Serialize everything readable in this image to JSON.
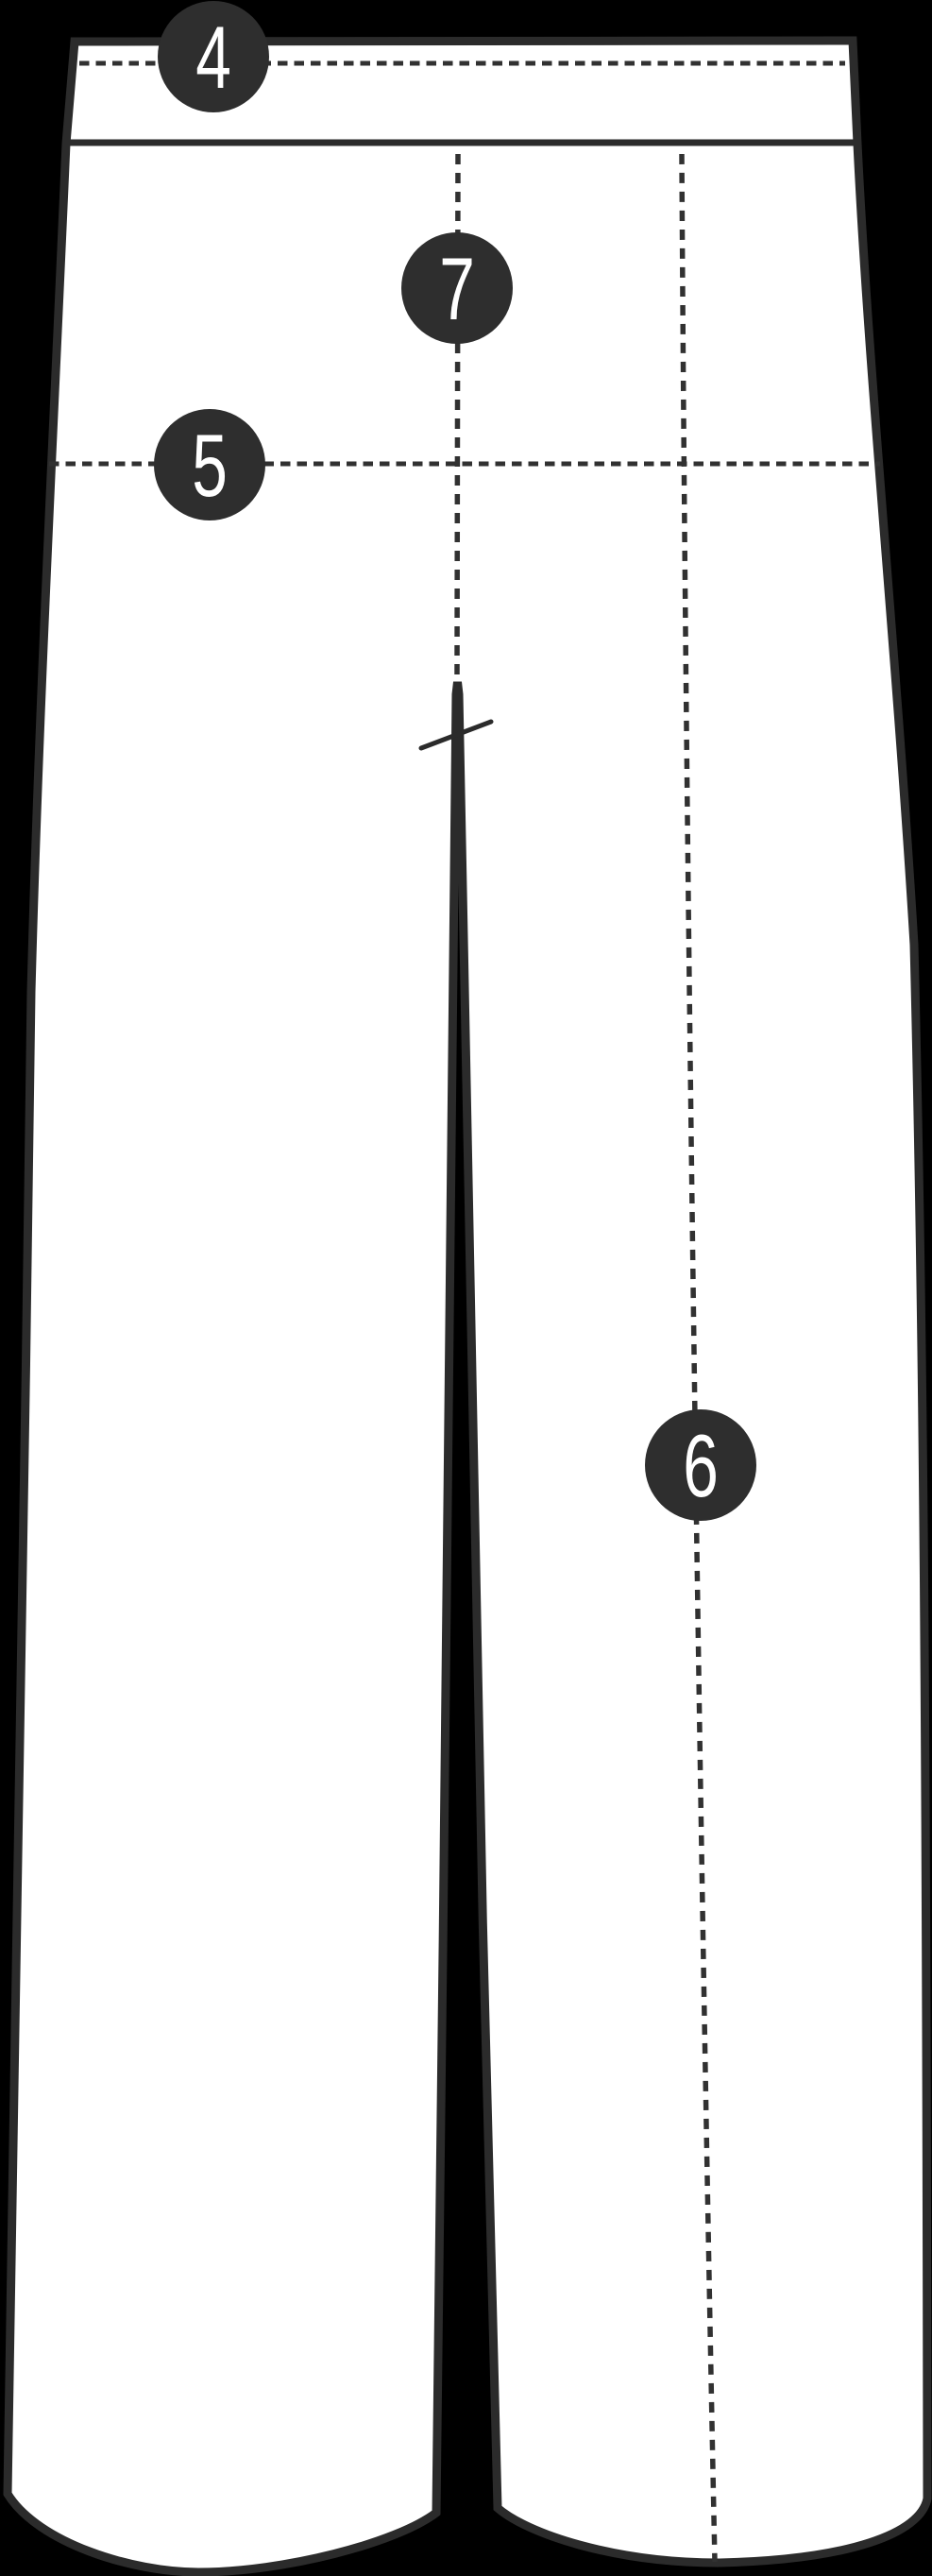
{
  "diagram": {
    "subject": "pants-size-guide-back-view",
    "markers": [
      {
        "label": "4",
        "line_orientation": "horizontal",
        "line_style": "dashed",
        "position": "waistband"
      },
      {
        "label": "7",
        "line_orientation": "vertical",
        "line_style": "dashed",
        "position": "front-rise-crease"
      },
      {
        "label": "5",
        "line_orientation": "horizontal",
        "line_style": "dashed",
        "position": "hip-line"
      },
      {
        "label": "6",
        "line_orientation": "vertical",
        "line_style": "dashed",
        "position": "right-leg-crease"
      }
    ],
    "crotch_tick": {
      "style": "solid-slash"
    }
  },
  "colors": {
    "background": "#000000",
    "outline": "#2b2b2b",
    "garment_fill": "#ffffff",
    "dash_line": "#313131",
    "badge": "#2e2e2e",
    "badge_text": "#ffffff"
  }
}
